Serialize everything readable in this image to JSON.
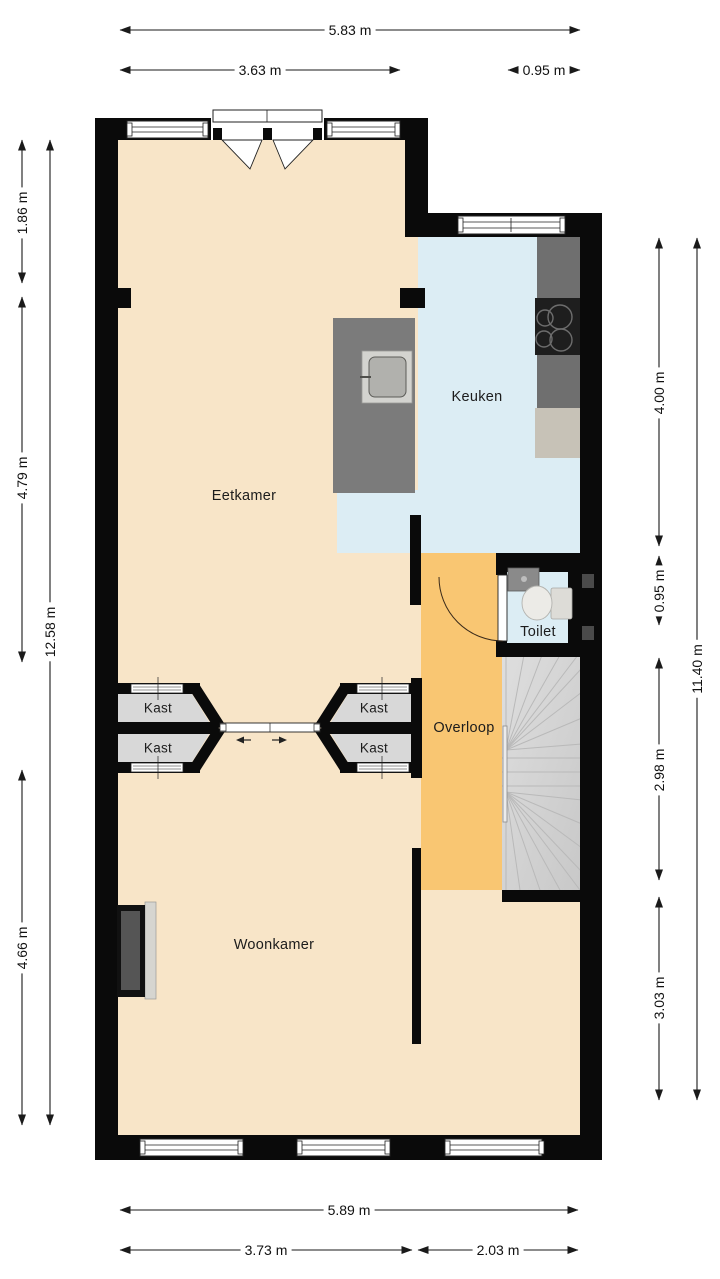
{
  "plan": {
    "type": "floor-plan",
    "rooms": {
      "eetkamer": "Eetkamer",
      "keuken": "Keuken",
      "overloop": "Overloop",
      "toilet": "Toilet",
      "woonkamer": "Woonkamer",
      "kast": "Kast"
    },
    "fixtures": [
      "island-with-sink",
      "cooktop",
      "kitchen-counter",
      "refrigerator-counter",
      "toilet-bowl",
      "toilet-hand-sink",
      "winder-staircase",
      "sliding-door",
      "french-doors",
      "fireplace",
      "closets"
    ],
    "dimensions": {
      "top_total": "5.83 m",
      "top_left": "3.63 m",
      "top_right": "0.95 m",
      "left_1": "1.86 m",
      "left_2": "4.79 m",
      "left_3": "4.66 m",
      "left_total": "12.58 m",
      "right_1": "4.00 m",
      "right_2": "0.95 m",
      "right_3": "2.98 m",
      "right_4": "3.03 m",
      "right_total": "11.40 m",
      "bottom_total": "5.89 m",
      "bottom_left": "3.73 m",
      "bottom_right": "2.03 m"
    },
    "colors": {
      "wall_black": "#0a0a0a",
      "floor_beige": "#f8e5c8",
      "kitchen_blue": "#dcedf4",
      "overloop_orange": "#f9c672",
      "closet_gray": "#d8d8d8",
      "counter_dark_gray": "#6f6f6f",
      "appliance_gray": "#c7c2b7",
      "stair_gray": "#d2d2d2",
      "dimension_line": "#1a1a1a"
    }
  }
}
